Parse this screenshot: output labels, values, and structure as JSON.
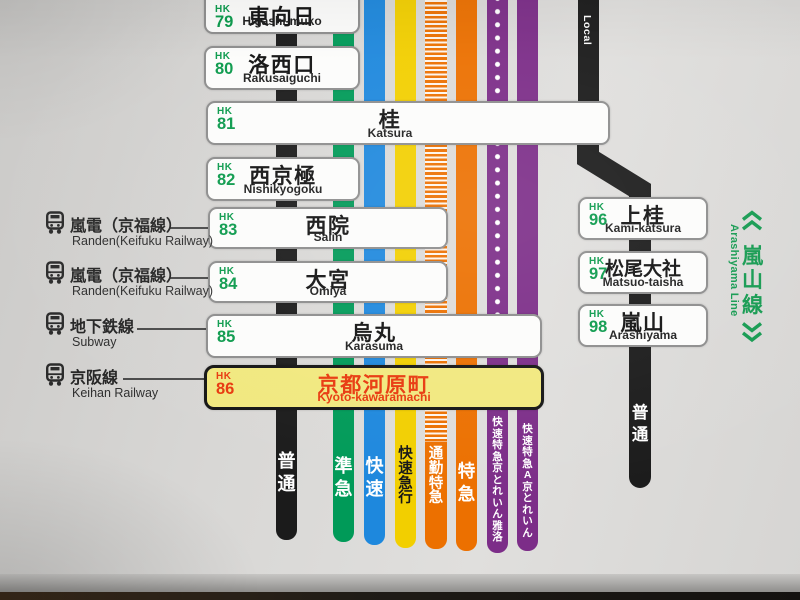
{
  "colors": {
    "background": "#d8d7d5",
    "station_number_green": "#0b9a4c",
    "highlight_box_fill": "#f1e87e",
    "highlight_text": "#e8380d",
    "branch_label_green": "#149a50",
    "box_border_gray": "#8d8d8d"
  },
  "main_line": {
    "stations": [
      {
        "prefix": "HK",
        "number": "79",
        "name_ja": "東向日",
        "name_en": "Higashi-muko",
        "highlighted": false
      },
      {
        "prefix": "HK",
        "number": "80",
        "name_ja": "洛西口",
        "name_en": "Rakusaiguchi",
        "highlighted": false
      },
      {
        "prefix": "HK",
        "number": "81",
        "name_ja": "桂",
        "name_en": "Katsura",
        "highlighted": false
      },
      {
        "prefix": "HK",
        "number": "82",
        "name_ja": "西京極",
        "name_en": "Nishikyogoku",
        "highlighted": false
      },
      {
        "prefix": "HK",
        "number": "83",
        "name_ja": "西院",
        "name_en": "Saiin",
        "highlighted": false,
        "transfer": {
          "name_ja": "嵐電（京福線）",
          "name_en": "Randen(Keifuku Railway)"
        }
      },
      {
        "prefix": "HK",
        "number": "84",
        "name_ja": "大宮",
        "name_en": "Omiya",
        "highlighted": false,
        "transfer": {
          "name_ja": "嵐電（京福線）",
          "name_en": "Randen(Keifuku Railway)"
        }
      },
      {
        "prefix": "HK",
        "number": "85",
        "name_ja": "烏丸",
        "name_en": "Karasuma",
        "highlighted": false,
        "transfer": {
          "name_ja": "地下鉄線",
          "name_en": "Subway"
        }
      },
      {
        "prefix": "HK",
        "number": "86",
        "name_ja": "京都河原町",
        "name_en": "Kyoto-kawaramachi",
        "highlighted": true,
        "transfer": {
          "name_ja": "京阪線",
          "name_en": "Keihan Railway"
        }
      }
    ],
    "services": [
      {
        "label": "普通",
        "color": "#1b1b1b",
        "pattern": "solid",
        "text_color": "#ffffff"
      },
      {
        "label": "準急",
        "color": "#009a58",
        "pattern": "solid",
        "text_color": "#ffffff"
      },
      {
        "label": "快速",
        "color": "#1e88dd",
        "pattern": "solid",
        "text_color": "#ffffff"
      },
      {
        "label": "快速急行",
        "color": "#f2cf00",
        "pattern": "solid",
        "text_color": "#161616"
      },
      {
        "label": "通勤特急",
        "color": "#ec7000",
        "pattern": "ladder",
        "text_color": "#ffffff"
      },
      {
        "label": "特急",
        "color": "#ec7000",
        "pattern": "solid",
        "text_color": "#ffffff"
      },
      {
        "label": "快速特急　京とれいん雅洛",
        "color": "#7c2d88",
        "pattern": "dotted",
        "text_color": "#ffffff"
      },
      {
        "label": "快速特急A　京とれいん",
        "color": "#7c2d88",
        "pattern": "solid",
        "text_color": "#ffffff"
      }
    ]
  },
  "branch_line": {
    "name_ja": "嵐山線",
    "name_en": "Arashiyama Line",
    "feeder_label": "Local",
    "service_label": "普通",
    "stations": [
      {
        "prefix": "HK",
        "number": "96",
        "name_ja": "上桂",
        "name_en": "Kami-katsura"
      },
      {
        "prefix": "HK",
        "number": "97",
        "name_ja": "松尾大社",
        "name_en": "Matsuo-taisha"
      },
      {
        "prefix": "HK",
        "number": "98",
        "name_ja": "嵐山",
        "name_en": "Arashiyama"
      }
    ]
  }
}
